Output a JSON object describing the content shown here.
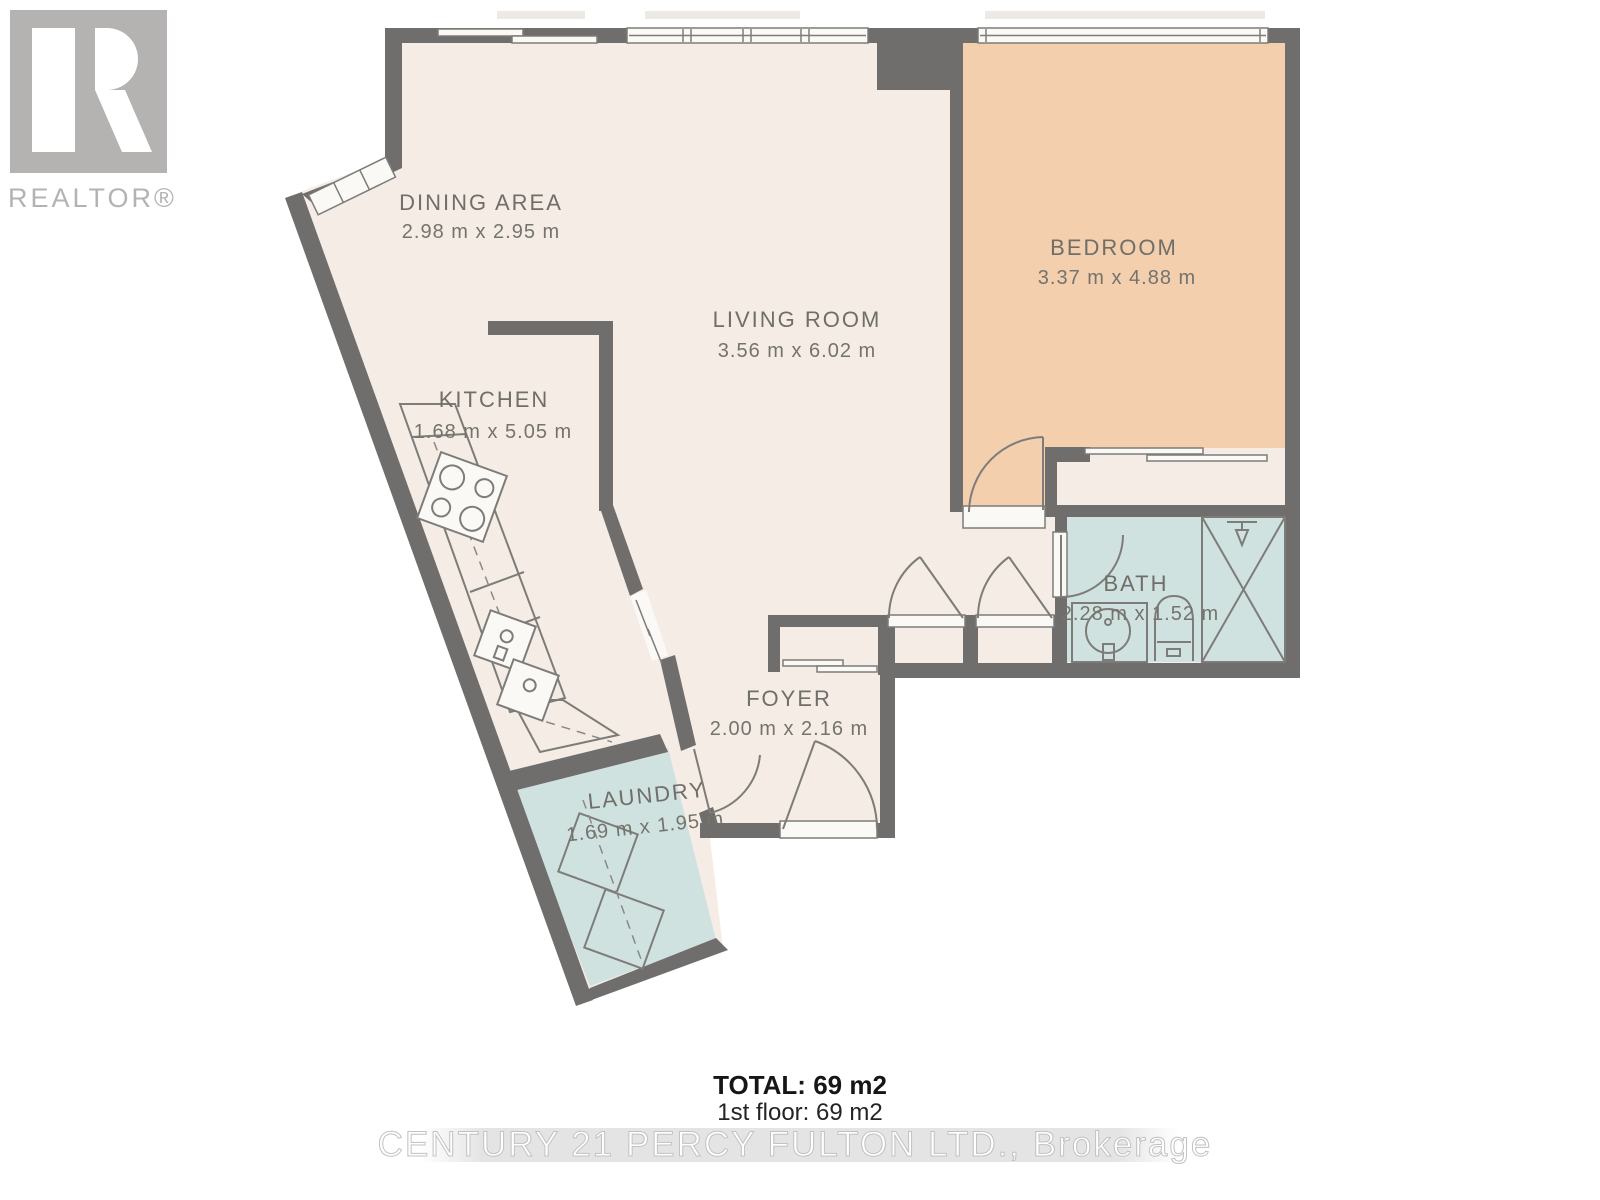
{
  "branding": {
    "logo_label": "REALTOR®",
    "watermark": "CENTURY 21 PERCY FULTON LTD., Brokerage"
  },
  "rooms": {
    "dining": {
      "name": "DINING AREA",
      "dims": "2.98 m x 2.95 m"
    },
    "living": {
      "name": "LIVING ROOM",
      "dims": "3.56 m x 6.02 m"
    },
    "kitchen": {
      "name": "KITCHEN",
      "dims": "1.68 m x 5.05 m"
    },
    "bedroom": {
      "name": "BEDROOM",
      "dims": "3.37 m x 4.88 m"
    },
    "bath": {
      "name": "BATH",
      "dims": "2.28 m x 1.52 m"
    },
    "foyer": {
      "name": "FOYER",
      "dims": "2.00 m x 2.16 m"
    },
    "laundry": {
      "name": "LAUNDRY",
      "dims": "1.69 m x 1.95 m"
    }
  },
  "summary": {
    "total": "TOTAL: 69 m2",
    "first_floor": "1st floor: 69 m2"
  },
  "colors": {
    "floor_main": "#f5ece6",
    "floor_bedroom": "#f3cfae",
    "floor_wet": "#cfe2e0",
    "wall": "#6f6e6c",
    "label_text": "#6f6e68",
    "logo_gray": "#b5b3b1"
  }
}
